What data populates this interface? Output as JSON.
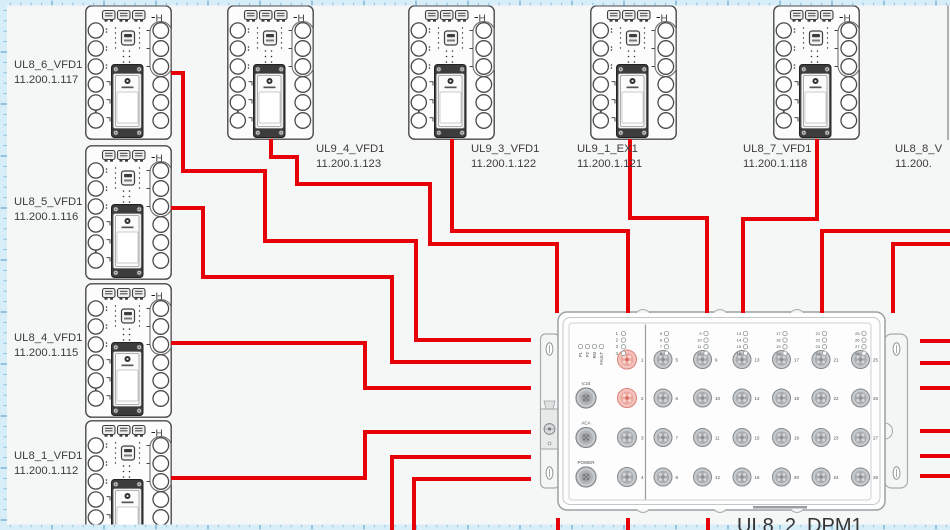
{
  "canvas": {
    "width": 950,
    "height": 530,
    "bg": "#f5f6f6",
    "ruler_bg": "#d7edf8",
    "tick_minor": "#8cc2e0",
    "tick_major": "#4e9cc9"
  },
  "wire": {
    "color": "#e60008",
    "width": 4
  },
  "device_symbol": {
    "top_right_mark": "H"
  },
  "devices": [
    {
      "name": "UL8_6_VFD1",
      "ip": "11.200.1.117",
      "x": 85,
      "y": 5,
      "label_x": 14,
      "label_y": 68,
      "body": "full"
    },
    {
      "name": "UL8_5_VFD1",
      "ip": "11.200.1.116",
      "x": 85,
      "y": 145,
      "label_x": 14,
      "label_y": 205,
      "body": "full"
    },
    {
      "name": "UL8_4_VFD1",
      "ip": "11.200.1.115",
      "x": 85,
      "y": 283,
      "label_x": 14,
      "label_y": 341,
      "body": "full"
    },
    {
      "name": "UL8_1_VFD1",
      "ip": "11.200.1.112",
      "x": 85,
      "y": 420,
      "label_x": 14,
      "label_y": 459,
      "body": "full"
    },
    {
      "name": "UL9_4_VFD1",
      "ip": "11.200.1.123",
      "x": 227,
      "y": 5,
      "label_x": 316,
      "label_y": 152,
      "body": "full"
    },
    {
      "name": "UL9_3_VFD1",
      "ip": "11.200.1.122",
      "x": 408,
      "y": 5,
      "label_x": 471,
      "label_y": 152,
      "body": "full"
    },
    {
      "name": "UL9_1_EX1",
      "ip": "11.200.1.121",
      "x": 590,
      "y": 5,
      "label_x": 577,
      "label_y": 152,
      "body": "full"
    },
    {
      "name": "UL8_7_VFD1",
      "ip": "11.200.1.118",
      "x": 773,
      "y": 5,
      "label_x": 743,
      "label_y": 152,
      "body": "full"
    },
    {
      "name": "UL8_8_V",
      "ip": "11.200.",
      "x": 948,
      "y": 5,
      "label_x": 895,
      "label_y": 152,
      "body": "edge"
    }
  ],
  "dpm": {
    "name": "UL8_2_DPM1",
    "label_x": 737,
    "label_y": 532,
    "status_leds": [
      "P1",
      "P2",
      "RM",
      "FAULT"
    ],
    "ports": [
      "V.24",
      "ACA",
      "POWER"
    ],
    "left_connectors": [
      "1",
      "2",
      "3",
      "4"
    ],
    "highlighted_connectors": [
      "1",
      "2"
    ],
    "grid_connectors": [
      "5",
      "6",
      "7",
      "8",
      "9",
      "10",
      "11",
      "12",
      "13",
      "14",
      "15",
      "16",
      "17",
      "18",
      "19",
      "20",
      "21",
      "22",
      "23",
      "24",
      "25",
      "26",
      "27",
      "28"
    ]
  },
  "wires": [
    {
      "name": "cable-ul8-6-vfd1-to-dpm",
      "points": [
        [
          171,
          73
        ],
        [
          183,
          73
        ],
        [
          183,
          171
        ],
        [
          265,
          171
        ],
        [
          265,
          241
        ],
        [
          416,
          241
        ],
        [
          416,
          340
        ],
        [
          531,
          340
        ]
      ]
    },
    {
      "name": "cable-ul8-5-vfd1-to-dpm",
      "points": [
        [
          171,
          208
        ],
        [
          203,
          208
        ],
        [
          203,
          277
        ],
        [
          392,
          277
        ],
        [
          392,
          362
        ],
        [
          531,
          362
        ]
      ]
    },
    {
      "name": "cable-ul8-4-vfd1-to-dpm",
      "points": [
        [
          171,
          343
        ],
        [
          365,
          343
        ],
        [
          365,
          388
        ],
        [
          531,
          388
        ]
      ]
    },
    {
      "name": "cable-ul8-1-vfd1-to-dpm",
      "points": [
        [
          171,
          478
        ],
        [
          365,
          478
        ],
        [
          365,
          432
        ],
        [
          531,
          432
        ]
      ]
    },
    {
      "name": "cable-bottom-a-to-dpm",
      "points": [
        [
          392,
          532
        ],
        [
          392,
          457
        ],
        [
          531,
          457
        ]
      ]
    },
    {
      "name": "cable-bottom-b-to-dpm",
      "points": [
        [
          414,
          532
        ],
        [
          414,
          479
        ],
        [
          531,
          479
        ]
      ]
    },
    {
      "name": "cable-ul9-4-vfd1-to-dpm",
      "points": [
        [
          271,
          139
        ],
        [
          271,
          157
        ],
        [
          297,
          157
        ],
        [
          297,
          184
        ],
        [
          430,
          184
        ],
        [
          430,
          244
        ],
        [
          557,
          244
        ],
        [
          557,
          313
        ]
      ]
    },
    {
      "name": "cable-ul9-3-vfd1-to-dpm",
      "points": [
        [
          452,
          139
        ],
        [
          452,
          231
        ],
        [
          628,
          231
        ],
        [
          628,
          313
        ]
      ]
    },
    {
      "name": "cable-ul9-1-ex1-to-dpm",
      "points": [
        [
          630,
          139
        ],
        [
          630,
          218
        ],
        [
          707,
          218
        ],
        [
          707,
          313
        ]
      ]
    },
    {
      "name": "cable-ul8-7-vfd1-to-dpm",
      "points": [
        [
          817,
          139
        ],
        [
          817,
          219
        ],
        [
          743,
          219
        ],
        [
          743,
          313
        ]
      ]
    },
    {
      "name": "cable-right-a-to-dpm",
      "points": [
        [
          951,
          231
        ],
        [
          822,
          231
        ],
        [
          822,
          313
        ]
      ]
    },
    {
      "name": "cable-right-b-to-dpm",
      "points": [
        [
          951,
          244
        ],
        [
          893,
          244
        ],
        [
          893,
          313
        ]
      ]
    },
    {
      "name": "cable-stub-right-1",
      "points": [
        [
          920,
          341
        ],
        [
          951,
          341
        ]
      ]
    },
    {
      "name": "cable-stub-right-2",
      "points": [
        [
          920,
          363
        ],
        [
          951,
          363
        ]
      ]
    },
    {
      "name": "cable-stub-right-3",
      "points": [
        [
          920,
          388
        ],
        [
          951,
          388
        ]
      ]
    },
    {
      "name": "cable-stub-right-4",
      "points": [
        [
          920,
          431
        ],
        [
          951,
          431
        ]
      ]
    },
    {
      "name": "cable-stub-right-5",
      "points": [
        [
          920,
          456
        ],
        [
          951,
          456
        ]
      ]
    },
    {
      "name": "cable-stub-right-6",
      "points": [
        [
          920,
          476
        ],
        [
          951,
          476
        ]
      ]
    },
    {
      "name": "cable-stub-bottom-1",
      "points": [
        [
          558,
          518
        ],
        [
          558,
          531
        ]
      ]
    },
    {
      "name": "cable-stub-bottom-2",
      "points": [
        [
          628,
          518
        ],
        [
          628,
          531
        ]
      ]
    },
    {
      "name": "cable-stub-bottom-3",
      "points": [
        [
          708,
          518
        ],
        [
          708,
          531
        ]
      ]
    }
  ]
}
